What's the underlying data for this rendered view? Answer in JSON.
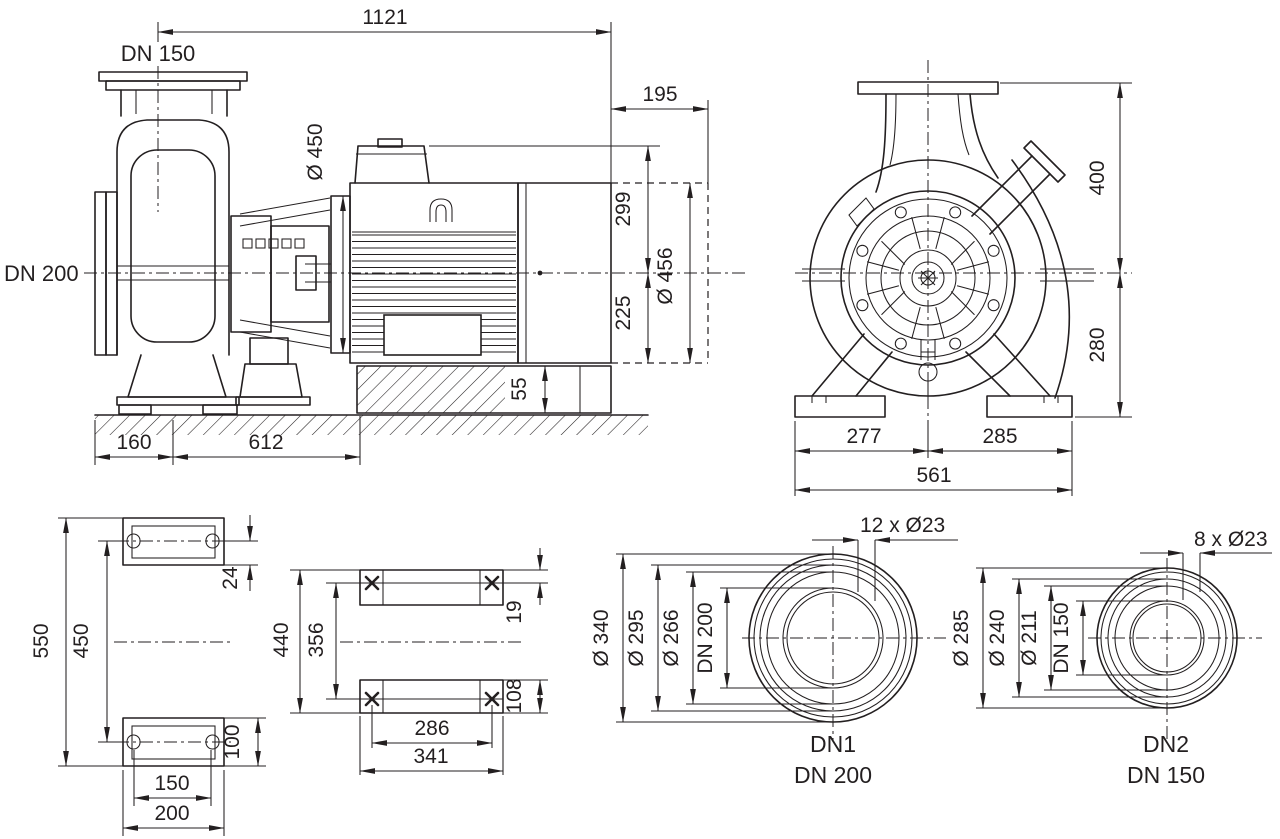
{
  "drawing_type": "pump-dimensional-drawing",
  "colors": {
    "line": "#231f20",
    "background": "#ffffff"
  },
  "views": {
    "side": {
      "discharge_flange": "DN 150",
      "suction_flange": "DN 200",
      "overall_length": "1121",
      "rear_overhang": "195",
      "motor_flange_dia": "Ø 450",
      "center_to_top": "299",
      "center_to_base": "225",
      "fan_cover_dia": "Ø 456",
      "foundation_height": "55",
      "front_offset": "160",
      "base_length": "612"
    },
    "end": {
      "center_to_flange_top": "400",
      "center_to_foot_bottom": "280",
      "foot_left_of_center": "277",
      "foot_right_of_center": "285",
      "foot_overall_width": "561"
    },
    "pads": {
      "overall_height": "550",
      "hole_pitch_vertical": "450",
      "top_hole_offset": "24",
      "bottom_pad_height": "100",
      "hole_pitch_horizontal": "150",
      "pad_width": "200"
    },
    "feet": {
      "overall_length": "440",
      "hole_pitch_vertical": "356",
      "top_hole_offset": "19",
      "bottom_pad_height": "108",
      "hole_pitch_horizontal": "286",
      "overall_width": "341"
    },
    "dn1": {
      "bolt_pattern": "12 x Ø23",
      "outer_dia": "Ø 340",
      "bolt_circle_dia": "Ø 295",
      "raised_face_dia": "Ø 266",
      "nominal_bore": "DN 200",
      "port_id": "DN1",
      "port_size": "DN 200"
    },
    "dn2": {
      "bolt_pattern": "8 x Ø23",
      "outer_dia": "Ø 285",
      "bolt_circle_dia": "Ø 240",
      "raised_face_dia": "Ø 211",
      "nominal_bore": "DN 150",
      "port_id": "DN2",
      "port_size": "DN 150"
    }
  }
}
